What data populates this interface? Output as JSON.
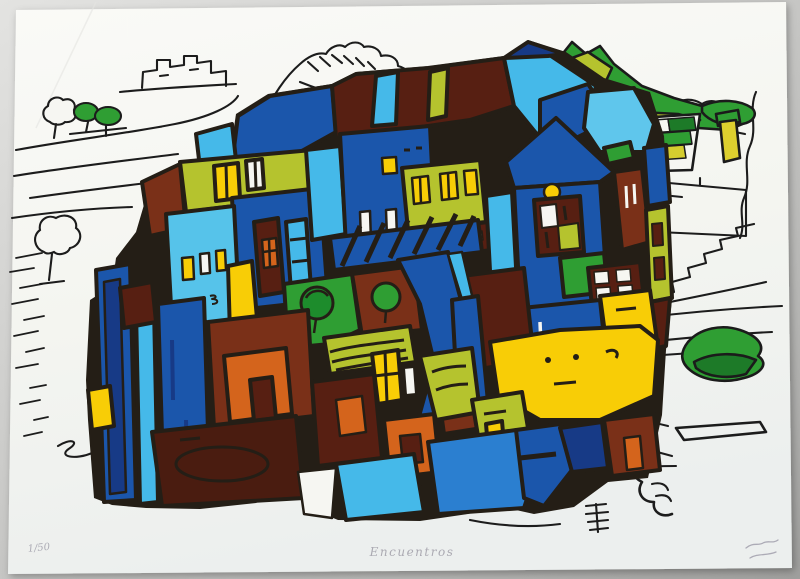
{
  "artwork": {
    "subject": "Abstract serigraph of a dense village of stacked houses with outlined hills, a sketched mountain, green fields and trees",
    "medium_visible": "color screen print on white paper, photographed on gray backdrop",
    "palette": {
      "outline_black": "#241e16",
      "royal_blue": "#1b56ab",
      "navy_blue": "#173a86",
      "cyan_blue": "#45b9e9",
      "light_cyan": "#5fc6ec",
      "medium_blue": "#2b7fd0",
      "bright_green": "#2f9e33",
      "dark_green": "#1d7a28",
      "olive_green": "#b5c32e",
      "yellow": "#f8cd06",
      "checker_yellow": "#d5cd2f",
      "orange": "#d4641c",
      "red_brown": "#7a3018",
      "dark_maroon": "#571f12",
      "paper_white": "#f5f5f1",
      "backdrop_gray": "#b7b7b5"
    }
  },
  "inscriptions": {
    "edition_number": "1/50",
    "title": "Encuentros"
  }
}
